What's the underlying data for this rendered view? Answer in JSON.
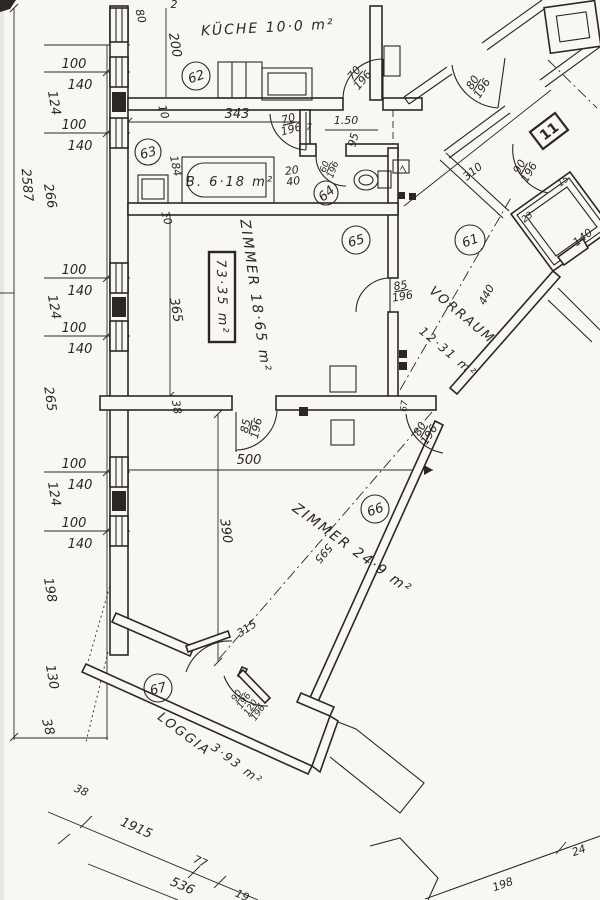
{
  "rooms": {
    "kueche": {
      "number": "62",
      "label": "KÜCHE 10·0 m²"
    },
    "bad": {
      "number": "63",
      "label": "B. 6·18 m²"
    },
    "wc": {
      "number": "64"
    },
    "zimmer1": {
      "number": "65",
      "label": "ZIMMER 18·65 m²",
      "area_box": "73·35 m²"
    },
    "vorraum": {
      "number": "61",
      "label": "VORRAUM",
      "area": "12·31 m²"
    },
    "zimmer2": {
      "number": "66",
      "label": "ZIMMER 24·9 m²"
    },
    "loggia": {
      "number": "67",
      "label": "LOGGIA",
      "area": "3·93 m²"
    },
    "unit": "11"
  },
  "doors": {
    "kitchen": "70/196",
    "bath": "70/196",
    "wc": "60/196",
    "zimmer1": "85/196",
    "zimmer2": "85/196",
    "vorraum_z2": "80/196",
    "entry": "90/196",
    "stair": "80/196",
    "loggia_a": "90/196",
    "loggia_b": "120/196"
  },
  "dims": {
    "total_height": "2587",
    "top_w": "80",
    "top_edge": "2",
    "chain": [
      {
        "w": "100",
        "h": "140"
      },
      {
        "w": "100",
        "h": "140"
      },
      {
        "w": "100",
        "h": "140"
      },
      {
        "w": "100",
        "h": "140"
      },
      {
        "w": "100",
        "h": "140"
      },
      {
        "w": "100",
        "h": "140"
      }
    ],
    "gaps": [
      "124",
      "266",
      "124",
      "265",
      "124",
      "198"
    ],
    "tail_130": "130",
    "tail_38": "38",
    "kitchen_h": "200",
    "kitchen_w": "343",
    "wall10": "10",
    "corr_150": "1.50",
    "corr_95": "95",
    "corr_7": "7",
    "bath_184": "184",
    "niche_2040": "20/40",
    "wc_7": "7",
    "z1_365": "365",
    "z1_38": "38",
    "z1_67": "67",
    "entry_310": "310",
    "entry_15": "15",
    "entry_23": "23",
    "lift_140": "140",
    "vor_440": "440",
    "z2_500": "500",
    "z2_390": "390",
    "z2_595": "595",
    "z2_315": "315",
    "b_38": "38",
    "b_1915": "1915",
    "b_77": "77",
    "b_536": "536",
    "b_19": "19",
    "b_198": "198",
    "b_24": "24"
  }
}
